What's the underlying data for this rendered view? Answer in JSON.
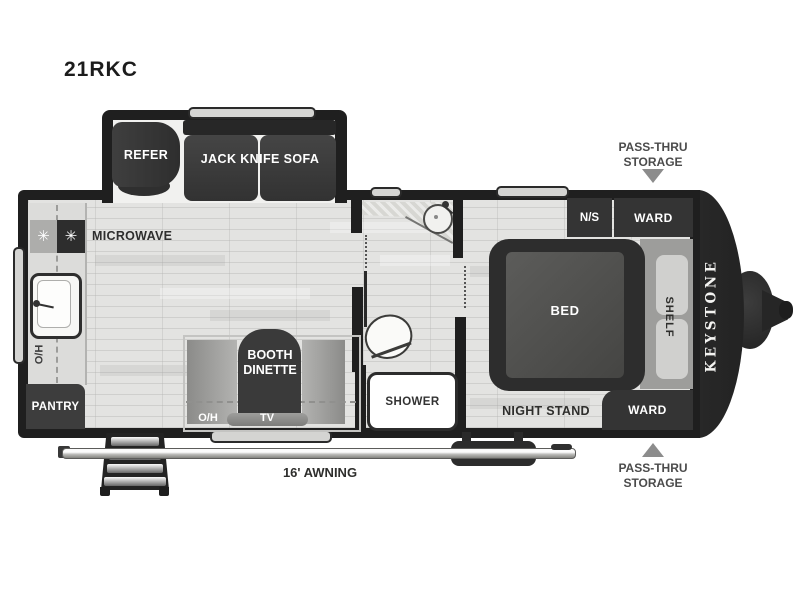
{
  "model": "21RKC",
  "brand": "KEYSTONE",
  "annotations": {
    "pass_thru_storage": "PASS-THRU STORAGE",
    "awning": "16' AWNING"
  },
  "labels": {
    "refer": "REFER",
    "jack_knife_sofa": "JACK KNIFE SOFA",
    "microwave": "MICROWAVE",
    "oh": "O/H",
    "pantry": "PANTRY",
    "booth_dinette": "BOOTH DINETTE",
    "tv": "TV",
    "shower": "SHOWER",
    "ns": "N/S",
    "ward": "WARD",
    "shelf": "SHELF",
    "bed": "BED",
    "night_stand": "NIGHT STAND"
  },
  "icons": {
    "burner": "✳"
  },
  "colors": {
    "wall": "#1f1f1f",
    "furniture_dark": "#343434",
    "floor": "#e3e3e1",
    "counter": "#dcdcda",
    "bench_gray": "#a6a6a4",
    "shelf_bg": "#9d9d9b",
    "annotation_gray": "#4b4b4b",
    "arrow_gray": "#8c8c8c",
    "white": "#ffffff"
  }
}
